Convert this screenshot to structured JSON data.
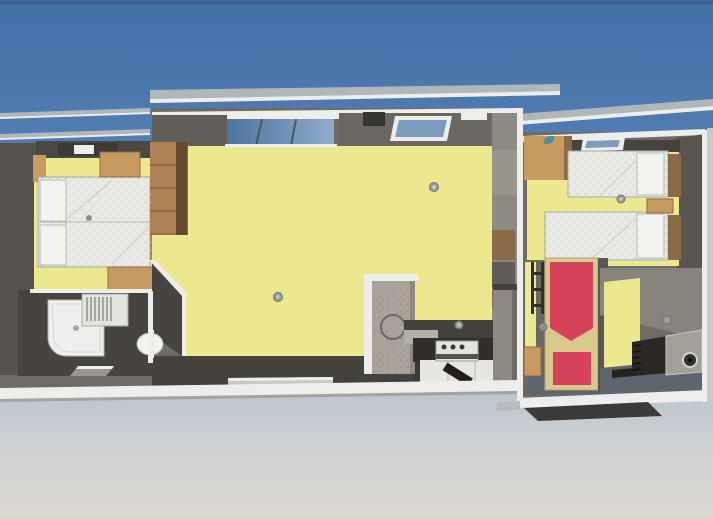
{
  "meta": {
    "title": "3D rendered floor plan — elongated modular holiday home, top-down view",
    "type": "architectural-rendering",
    "text_on_screen": "none"
  },
  "palette": {
    "sky_top": "#426fa6",
    "sky_mid": "#5d86ba",
    "sky_low": "#7b9cc6",
    "ground_top": "#b7c3cf",
    "ground_mid": "#cfd2d2",
    "ground_bottom": "#dcd8d1",
    "roof_strip": "#b3b6b8",
    "fascia_white": "#edeeec",
    "wall_dark": "#55514c",
    "wall_mid": "#6e6a65",
    "wall_light": "#8d8983",
    "floor_yellow": "#ece88f",
    "mattress": "#e9e9e5",
    "wood": "#c79a62",
    "wood_dark": "#8a6a48",
    "bed_red": "#d6425a",
    "bed_frame_tan": "#d9c98c",
    "window_glass": "#6d8fb5",
    "counter_dark": "#312e2a",
    "cabinet_white": "#e8e6e2",
    "floor_slate": "#5d6570",
    "partition_gray": "#aaa39c",
    "teal_accent": "#4e8d9c"
  },
  "scene": {
    "environment": [
      "sky",
      "ground",
      "roof-overhang-strips",
      "entrance-step",
      "rear-step"
    ],
    "modules": [
      {
        "name": "left-module",
        "rooms": [
          {
            "name": "master-bedroom",
            "floor": "yellow",
            "furniture": [
              "double-bed",
              "two-pillows",
              "nightstand-top",
              "nightstand-bottom",
              "wood-wall-column",
              "wall-shelf-unit",
              "roof-skylight"
            ]
          },
          {
            "name": "bathroom",
            "floor": "dark-gray",
            "furniture": [
              "shower-tray-with-drain",
              "ribbed-washbasin-unit",
              "toilet",
              "floor-vent"
            ]
          },
          {
            "name": "living-room",
            "floor": "yellow",
            "furniture": [
              "large-front-window",
              "roof-hatch",
              "roof-skylight",
              "ceiling-lamp",
              "ceiling-lamp",
              "freestanding-partition-with-circle",
              "entry-threshold-step",
              "wall-shelving-column"
            ]
          },
          {
            "name": "kitchen",
            "floor": "dark-gray",
            "furniture": [
              "countertop",
              "cooktop-with-knobs",
              "white-base-cabinets",
              "tall-fridge-cabinet",
              "floor-mat",
              "ceiling-lamp"
            ]
          }
        ]
      },
      {
        "name": "right-module",
        "rooms": [
          {
            "name": "twin-bedroom",
            "floor": "yellow",
            "furniture": [
              "twin-bed-upper",
              "twin-bed-lower",
              "two-pillows",
              "wardrobe-cabinet",
              "nightstand",
              "teal-object",
              "roof-skylight",
              "ceiling-lamp"
            ]
          },
          {
            "name": "single-bedroom",
            "floor": "slate",
            "furniture": [
              "red-single-bed",
              "tan-bed-frame",
              "bunk-ladder",
              "small-wood-cabinet",
              "wall-lamp"
            ]
          },
          {
            "name": "utility-room",
            "floor": "yellow-and-slate",
            "furniture": [
              "ribbed-heater-unit",
              "boiler-box-with-port",
              "wall-lamp"
            ]
          }
        ]
      }
    ]
  }
}
